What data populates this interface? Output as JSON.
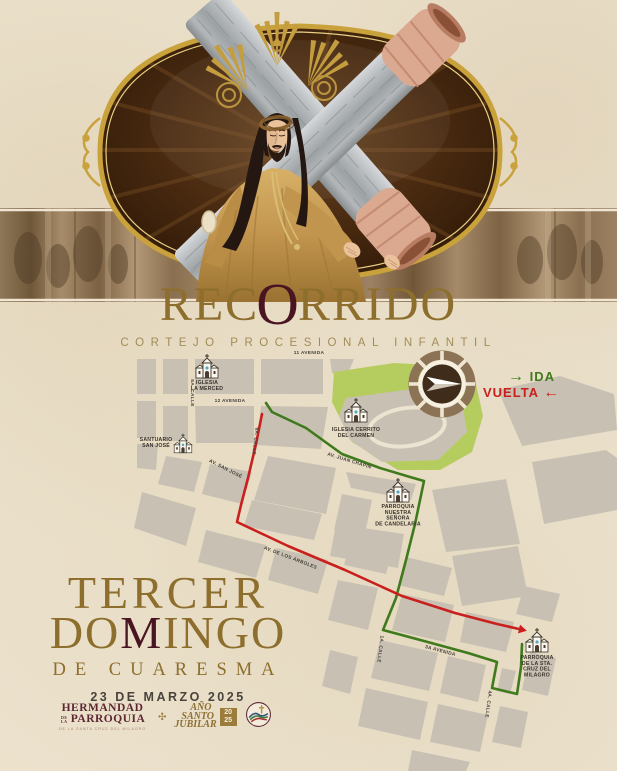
{
  "title": {
    "parts": [
      {
        "t": "REC",
        "cls": "gold"
      },
      {
        "t": "O",
        "cls": "maroon"
      },
      {
        "t": "RRIDO",
        "cls": "gold"
      }
    ],
    "subtitle": "CORTEJO PROCESIONAL INFANTIL"
  },
  "legend": {
    "ida_label": "IDA",
    "vuelta_label": "VUELTA",
    "ida_arrow": "→",
    "vuelta_arrow": "←",
    "ida_color": "#3f7a1c",
    "vuelta_color": "#c9201d"
  },
  "event": {
    "line1": "TERCER",
    "line2_parts": [
      {
        "t": "DO",
        "cls": "gold"
      },
      {
        "t": "M",
        "cls": "maroon"
      },
      {
        "t": "INGO",
        "cls": "gold"
      }
    ],
    "line3": "DE CUARESMA",
    "date": "23 DE MARZO 2025"
  },
  "footer": {
    "hermandad_line1": "HERMANDAD",
    "hermandad_de_la": "DE LA",
    "hermandad_line2": "PARROQUIA",
    "hermandad_line3": "DE LA SANTA CRUZ DEL MILAGRO",
    "ornament": "✣",
    "jubilar_lines": [
      "AÑO",
      "SANTO",
      "JUBILAR"
    ],
    "jubilar_year_top": "20",
    "jubilar_year_bottom": "25"
  },
  "map": {
    "block_color": "#c8c1b3",
    "street_color": "#ece3d0",
    "park_color": "#b5cc5f",
    "icon": {
      "fill": "#fbf7ee",
      "stroke": "#3a332a",
      "door": "#4a3c2e",
      "window": "#58a8c0"
    },
    "park": [
      [
        334,
        372
      ],
      [
        394,
        363
      ],
      [
        447,
        366
      ],
      [
        476,
        384
      ],
      [
        483,
        416
      ],
      [
        472,
        452
      ],
      [
        440,
        470
      ],
      [
        398,
        470
      ],
      [
        352,
        442
      ],
      [
        332,
        402
      ]
    ],
    "hill": [
      [
        346,
        398
      ],
      [
        420,
        388
      ],
      [
        462,
        402
      ],
      [
        467,
        432
      ],
      [
        438,
        460
      ],
      [
        382,
        462
      ],
      [
        350,
        440
      ],
      [
        339,
        416
      ]
    ],
    "hill_ring": {
      "cx": 407,
      "cy": 427,
      "rx": 38,
      "ry": 19,
      "rot": -8
    },
    "blocks": [
      [
        [
          137,
          359
        ],
        [
          156,
          359
        ],
        [
          156,
          394
        ],
        [
          137,
          394
        ]
      ],
      [
        [
          163,
          359
        ],
        [
          188,
          359
        ],
        [
          188,
          394
        ],
        [
          163,
          394
        ]
      ],
      [
        [
          195,
          359
        ],
        [
          254,
          359
        ],
        [
          254,
          394
        ],
        [
          195,
          394
        ]
      ],
      [
        [
          261,
          359
        ],
        [
          323,
          359
        ],
        [
          323,
          394
        ],
        [
          261,
          394
        ]
      ],
      [
        [
          330,
          359
        ],
        [
          354,
          359
        ],
        [
          346,
          378
        ],
        [
          332,
          373
        ]
      ],
      [
        [
          137,
          401
        ],
        [
          156,
          401
        ],
        [
          156,
          438
        ],
        [
          137,
          438
        ]
      ],
      [
        [
          163,
          406
        ],
        [
          188,
          406
        ],
        [
          188,
          441
        ],
        [
          163,
          441
        ]
      ],
      [
        [
          195,
          406
        ],
        [
          254,
          406
        ],
        [
          254,
          443
        ],
        [
          196,
          443
        ]
      ],
      [
        [
          261,
          406
        ],
        [
          328,
          407
        ],
        [
          321,
          449
        ],
        [
          257,
          445
        ]
      ],
      [
        [
          137,
          444
        ],
        [
          158,
          444
        ],
        [
          156,
          470
        ],
        [
          137,
          468
        ]
      ],
      [
        [
          166,
          456
        ],
        [
          202,
          462
        ],
        [
          194,
          492
        ],
        [
          158,
          484
        ]
      ],
      [
        [
          210,
          464
        ],
        [
          252,
          472
        ],
        [
          242,
          504
        ],
        [
          202,
          494
        ]
      ],
      [
        [
          142,
          492
        ],
        [
          196,
          508
        ],
        [
          186,
          546
        ],
        [
          134,
          528
        ]
      ],
      [
        [
          206,
          530
        ],
        [
          266,
          545
        ],
        [
          256,
          578
        ],
        [
          198,
          562
        ]
      ],
      [
        [
          276,
          548
        ],
        [
          328,
          560
        ],
        [
          318,
          594
        ],
        [
          268,
          580
        ]
      ],
      [
        [
          268,
          456
        ],
        [
          336,
          468
        ],
        [
          326,
          514
        ],
        [
          254,
          500
        ]
      ],
      [
        [
          346,
          472
        ],
        [
          416,
          484
        ],
        [
          411,
          500
        ],
        [
          351,
          488
        ]
      ],
      [
        [
          342,
          494
        ],
        [
          372,
          500
        ],
        [
          364,
          538
        ],
        [
          334,
          530
        ]
      ],
      [
        [
          252,
          500
        ],
        [
          322,
          514
        ],
        [
          314,
          540
        ],
        [
          244,
          526
        ]
      ],
      [
        [
          336,
          524
        ],
        [
          404,
          534
        ],
        [
          398,
          568
        ],
        [
          330,
          556
        ]
      ],
      [
        [
          338,
          580
        ],
        [
          378,
          588
        ],
        [
          368,
          630
        ],
        [
          328,
          620
        ]
      ],
      [
        [
          432,
          490
        ],
        [
          506,
          479
        ],
        [
          520,
          544
        ],
        [
          446,
          552
        ]
      ],
      [
        [
          452,
          556
        ],
        [
          518,
          546
        ],
        [
          528,
          596
        ],
        [
          462,
          606
        ]
      ],
      [
        [
          532,
          462
        ],
        [
          606,
          450
        ],
        [
          617,
          458
        ],
        [
          617,
          510
        ],
        [
          544,
          524
        ]
      ],
      [
        [
          498,
          390
        ],
        [
          560,
          376
        ],
        [
          614,
          394
        ],
        [
          617,
          430
        ],
        [
          522,
          446
        ]
      ],
      [
        [
          406,
          557
        ],
        [
          452,
          568
        ],
        [
          444,
          596
        ],
        [
          398,
          585
        ]
      ],
      [
        [
          402,
          594
        ],
        [
          454,
          605
        ],
        [
          445,
          642
        ],
        [
          392,
          630
        ]
      ],
      [
        [
          466,
          612
        ],
        [
          514,
          622
        ],
        [
          506,
          652
        ],
        [
          460,
          642
        ]
      ],
      [
        [
          524,
          586
        ],
        [
          560,
          594
        ],
        [
          552,
          622
        ],
        [
          516,
          614
        ]
      ],
      [
        [
          380,
          640
        ],
        [
          438,
          653
        ],
        [
          429,
          691
        ],
        [
          371,
          678
        ]
      ],
      [
        [
          448,
          656
        ],
        [
          486,
          665
        ],
        [
          478,
          702
        ],
        [
          440,
          693
        ]
      ],
      [
        [
          502,
          668
        ],
        [
          516,
          671
        ],
        [
          510,
          694
        ],
        [
          497,
          691
        ]
      ],
      [
        [
          530,
          652
        ],
        [
          556,
          658
        ],
        [
          548,
          696
        ],
        [
          522,
          690
        ]
      ],
      [
        [
          366,
          688
        ],
        [
          428,
          702
        ],
        [
          420,
          740
        ],
        [
          358,
          726
        ]
      ],
      [
        [
          438,
          704
        ],
        [
          488,
          715
        ],
        [
          480,
          752
        ],
        [
          430,
          742
        ]
      ],
      [
        [
          500,
          706
        ],
        [
          528,
          712
        ],
        [
          521,
          748
        ],
        [
          492,
          742
        ]
      ],
      [
        [
          412,
          750
        ],
        [
          470,
          762
        ],
        [
          466,
          771
        ],
        [
          408,
          771
        ]
      ],
      [
        [
          350,
          542
        ],
        [
          392,
          551
        ],
        [
          386,
          574
        ],
        [
          344,
          565
        ]
      ],
      [
        [
          330,
          650
        ],
        [
          358,
          657
        ],
        [
          350,
          694
        ],
        [
          322,
          686
        ]
      ]
    ],
    "street_labels": [
      {
        "t": "11 AVENIDA",
        "x": 309,
        "y": 354,
        "r": 0
      },
      {
        "t": "12 AVENIDA",
        "x": 230,
        "y": 402,
        "r": 0
      },
      {
        "t": "5A. CALLE",
        "x": 191,
        "y": 393,
        "r": 90
      },
      {
        "t": "6A. CALLE",
        "x": 254,
        "y": 441,
        "r": 97
      },
      {
        "t": "AV. SAN JOSÉ",
        "x": 225,
        "y": 470,
        "r": 27
      },
      {
        "t": "AV. JUAN CHAPIN",
        "x": 349,
        "y": 462,
        "r": 17
      },
      {
        "t": "AV. DE LOS ÁRBOLES",
        "x": 290,
        "y": 559,
        "r": 21
      },
      {
        "t": "3A AVENIDA",
        "x": 440,
        "y": 652,
        "r": 15
      },
      {
        "t": "1A. CALLE",
        "x": 379,
        "y": 649,
        "r": 97
      },
      {
        "t": "4A. CALLE",
        "x": 487,
        "y": 704,
        "r": 97
      }
    ],
    "churches": [
      {
        "lines": [
          "IGLESIA",
          "LA MERCED"
        ],
        "x": 207,
        "y": 372,
        "s": 1,
        "label_x": 207,
        "label_y": 384
      },
      {
        "lines": [
          "SANTUARIO",
          "SAN JOSÉ"
        ],
        "x": 183,
        "y": 448,
        "s": 0.8,
        "label_x": 156,
        "label_y": 441
      },
      {
        "lines": [
          "IGLESIA CERRITO",
          "DEL CARMEN"
        ],
        "x": 356,
        "y": 416,
        "s": 1,
        "label_x": 356,
        "label_y": 431
      },
      {
        "lines": [
          "PARROQUIA",
          "NUESTRA",
          "SEÑORA",
          "DE CANDELARIA"
        ],
        "x": 398,
        "y": 496,
        "s": 1,
        "label_x": 398,
        "label_y": 508
      },
      {
        "lines": [
          "PARROQUIA",
          "DE LA STA.",
          "CRUZ DEL",
          "MILAGRO"
        ],
        "x": 537,
        "y": 646,
        "s": 1,
        "label_x": 537,
        "label_y": 659
      }
    ],
    "routes": [
      {
        "name": "ida",
        "color": "#3f7a1c",
        "width": 2.6,
        "points": [
          [
            266,
            403
          ],
          [
            272,
            412
          ],
          [
            306,
            428
          ],
          [
            342,
            454
          ],
          [
            380,
            468
          ],
          [
            410,
            477
          ],
          [
            424,
            481
          ],
          [
            415,
            524
          ],
          [
            406,
            560
          ],
          [
            396,
            598
          ],
          [
            383,
            630
          ],
          [
            424,
            641
          ],
          [
            468,
            653
          ],
          [
            497,
            662
          ],
          [
            492,
            688
          ],
          [
            517,
            694
          ],
          [
            521,
            667
          ],
          [
            522,
            644
          ]
        ]
      },
      {
        "name": "vuelta",
        "color": "#c9201d",
        "width": 2.6,
        "arrow_end": true,
        "points": [
          [
            262,
            414
          ],
          [
            256,
            444
          ],
          [
            248,
            478
          ],
          [
            241,
            505
          ],
          [
            237,
            522
          ],
          [
            288,
            546
          ],
          [
            345,
            570
          ],
          [
            402,
            596
          ],
          [
            455,
            613
          ],
          [
            497,
            624
          ],
          [
            519,
            629
          ]
        ]
      }
    ]
  }
}
